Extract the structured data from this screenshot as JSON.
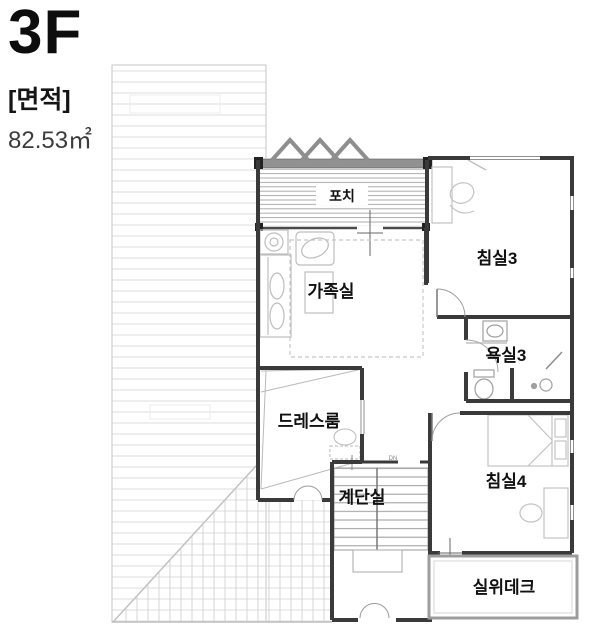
{
  "header": {
    "floor": "3F",
    "area_label": "[면적]",
    "area_value": "82.53㎡"
  },
  "rooms": {
    "porch": "포치",
    "bedroom3": "침실3",
    "family_room": "가족실",
    "bathroom3": "욕실3",
    "dressroom": "드레스룸",
    "staircase": "계단실",
    "bedroom4": "침실4",
    "deck": "실위데크"
  },
  "markers": {
    "stair_direction": "DN"
  },
  "colors": {
    "wall": "#3a3a3a",
    "roof_stripe": "#dedede",
    "porch_stripe": "#ababab",
    "furniture": "#bdbdbd",
    "text": "#111111"
  }
}
